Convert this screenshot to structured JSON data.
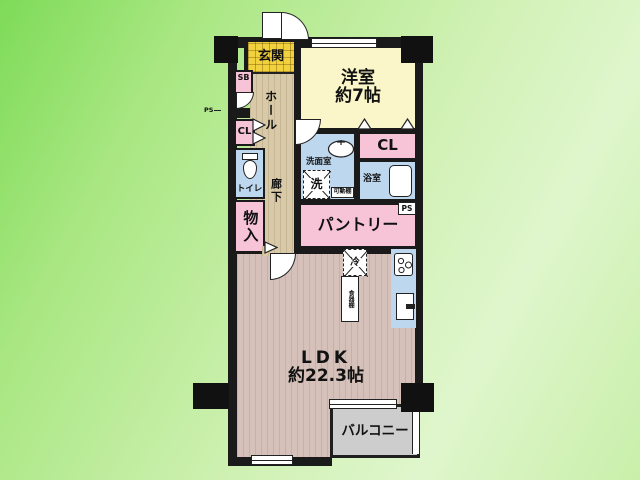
{
  "plan": {
    "entrance": {
      "label": "玄関"
    },
    "shoe_box": {
      "label": "SB"
    },
    "pipe_space_left": {
      "label": "PS"
    },
    "closet_left": {
      "label": "CL"
    },
    "toilet": {
      "label": "トイレ"
    },
    "storage": {
      "label": "物入"
    },
    "hall": {
      "label": "ホール"
    },
    "corridor": {
      "label": "廊下"
    },
    "western_room": {
      "label": "洋室",
      "size": "約7帖"
    },
    "washroom": {
      "label": "洗面室"
    },
    "washing_machine": {
      "label": "洗"
    },
    "movable_shelf": {
      "label": "可動棚"
    },
    "bathroom": {
      "label": "浴室"
    },
    "closet_right": {
      "label": "CL"
    },
    "pantry": {
      "label": "パントリー"
    },
    "pipe_space_right": {
      "label": "PS"
    },
    "refrigerator": {
      "label": "冷"
    },
    "cupboard": {
      "label": "食器棚"
    },
    "ldk": {
      "label": "LDK",
      "size": "約22.3帖"
    },
    "balcony": {
      "label": "バルコニー"
    }
  },
  "colors": {
    "background_green_dark": "#7edb58",
    "background_green_light": "#dff6cc",
    "wall": "#1a1a1a",
    "room_pink": "#f7c3d6",
    "room_blue": "#bcd7ee",
    "room_yellow_pale": "#faf6c9",
    "entrance_yellow": "#f2d13e",
    "hall_beige": "#d8c9a8",
    "ldk_taupe": "#d5c1b9",
    "balcony_gray": "#cdcdcd"
  }
}
